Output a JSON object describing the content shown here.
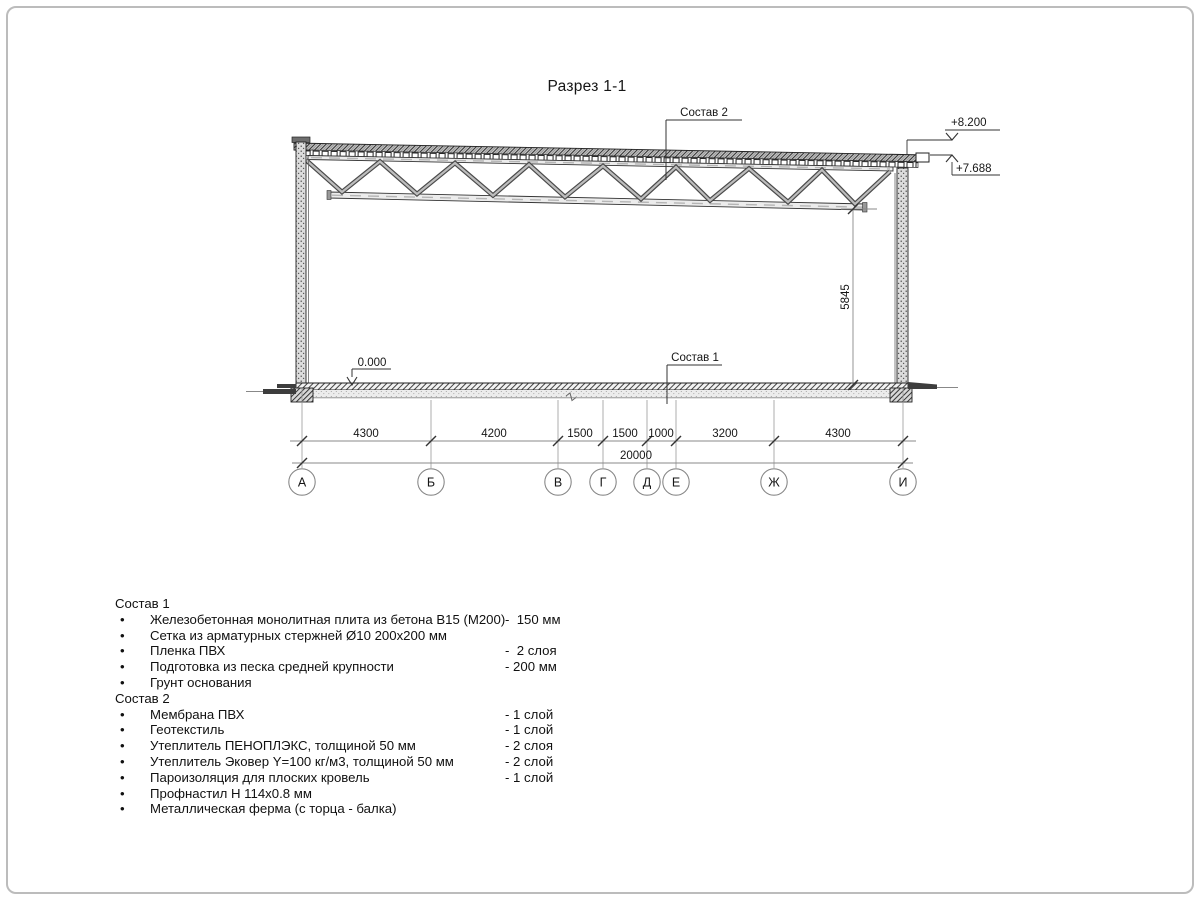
{
  "title": "Разрез 1-1",
  "drawing": {
    "roof_leader": "Состав 2",
    "floor_leader": "Состав 1",
    "elev_roof_top": "+8.200",
    "elev_roof_low": "+7.688",
    "elev_floor": "0.000",
    "dim_height": "5845",
    "dim_total": "20000",
    "dims": [
      "4300",
      "4200",
      "1500",
      "1500",
      "1000",
      "3200",
      "4300"
    ],
    "axes": [
      "А",
      "Б",
      "В",
      "Г",
      "Д",
      "Е",
      "Ж",
      "И"
    ]
  },
  "layers": {
    "bullet": "•",
    "s1_title": "Состав 1",
    "s1": [
      {
        "name": "Железобетонная монолитная плита из бетона В15 (М200)",
        "qty": "-  150 мм"
      },
      {
        "name": "Сетка из арматурных стержней Ø10 200х200 мм",
        "qty": ""
      },
      {
        "name": "Пленка ПВХ",
        "qty": "-  2 слоя"
      },
      {
        "name": "Подготовка из песка средней крупности",
        "qty": "- 200 мм"
      },
      {
        "name": "Грунт основания",
        "qty": ""
      }
    ],
    "s2_title": "Состав 2",
    "s2": [
      {
        "name": "Мембрана ПВХ",
        "qty": "- 1 слой"
      },
      {
        "name": "Геотекстиль",
        "qty": "- 1 слой"
      },
      {
        "name": "Утеплитель ПЕНОПЛЭКС, толщиной 50 мм",
        "qty": "- 2 слоя"
      },
      {
        "name": "Утеплитель Эковер Y=100 кг/м3, толщиной 50 мм",
        "qty": "- 2 слой"
      },
      {
        "name": "Пароизоляция для плоских кровель",
        "qty": "- 1 слой"
      },
      {
        "name": "Профнастил Н 114х0.8 мм",
        "qty": ""
      },
      {
        "name": "Металлическая ферма (с торца - балка)",
        "qty": ""
      }
    ]
  }
}
